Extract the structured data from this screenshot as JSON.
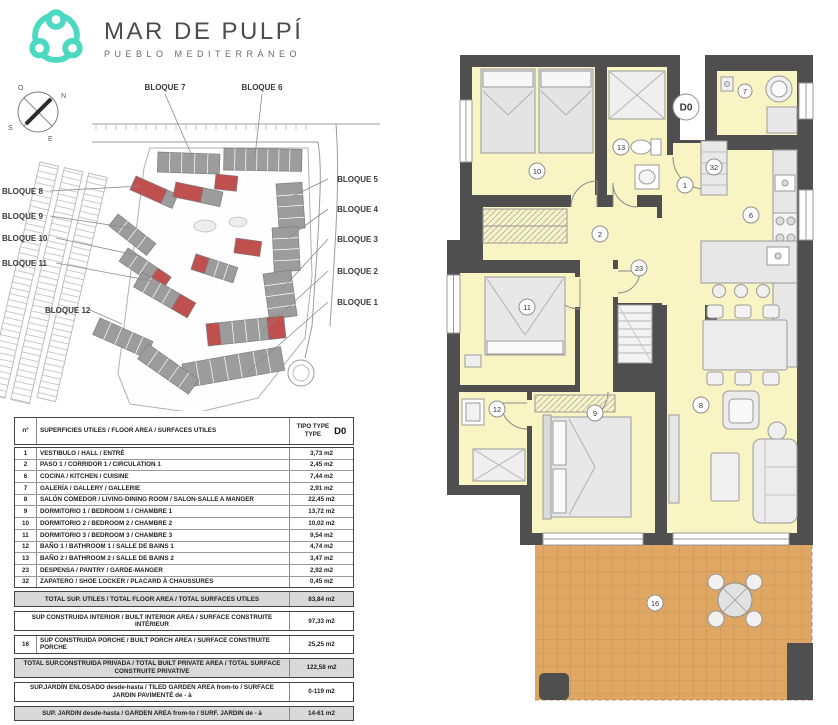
{
  "brand": {
    "title": "MAR DE PULPÍ",
    "subtitle": "PUEBLO MEDITERRÁNEO",
    "accent": "#4BD9C2"
  },
  "siteplan": {
    "compass": {
      "n": "N",
      "s": "S",
      "e": "E",
      "o": "O"
    },
    "blocks": [
      {
        "label": "BLOQUE 7",
        "x": 165,
        "y": 14,
        "anchor": "middle",
        "line": [
          165,
          18,
          192,
          80
        ]
      },
      {
        "label": "BLOQUE 6",
        "x": 262,
        "y": 14,
        "anchor": "middle",
        "line": [
          262,
          18,
          255,
          80
        ]
      },
      {
        "label": "BLOQUE 5",
        "x": 378,
        "y": 106,
        "anchor": "end",
        "line": [
          328,
          103,
          293,
          120
        ]
      },
      {
        "label": "BLOQUE 4",
        "x": 378,
        "y": 136,
        "anchor": "end",
        "line": [
          328,
          133,
          288,
          162
        ]
      },
      {
        "label": "BLOQUE 3",
        "x": 378,
        "y": 166,
        "anchor": "end",
        "line": [
          328,
          163,
          283,
          212
        ]
      },
      {
        "label": "BLOQUE 2",
        "x": 378,
        "y": 198,
        "anchor": "end",
        "line": [
          328,
          195,
          262,
          255
        ]
      },
      {
        "label": "BLOQUE 1",
        "x": 378,
        "y": 229,
        "anchor": "end",
        "line": [
          328,
          226,
          248,
          296
        ]
      },
      {
        "label": "BLOQUE 8",
        "x": 2,
        "y": 118,
        "anchor": "start",
        "line": [
          50,
          115,
          140,
          110
        ]
      },
      {
        "label": "BLOQUE 9",
        "x": 2,
        "y": 143,
        "anchor": "start",
        "line": [
          50,
          140,
          130,
          152
        ]
      },
      {
        "label": "BLOQUE 10",
        "x": 2,
        "y": 165,
        "anchor": "start",
        "line": [
          56,
          162,
          140,
          180
        ]
      },
      {
        "label": "BLOQUE 11",
        "x": 2,
        "y": 190,
        "anchor": "start",
        "line": [
          56,
          187,
          152,
          205
        ]
      },
      {
        "label": "BLOQUE 12",
        "x": 45,
        "y": 237,
        "anchor": "start",
        "line": [
          90,
          234,
          122,
          248
        ]
      }
    ]
  },
  "floorplan": {
    "unit_code": "D0",
    "colors": {
      "room": "#f8f4c3",
      "wall": "#4f4f4f",
      "terrace": "#dfa763"
    },
    "room_labels": [
      {
        "n": "D0",
        "x": 251,
        "y": 52,
        "r": 13,
        "big": true
      },
      {
        "n": "10",
        "x": 102,
        "y": 116,
        "r": 8
      },
      {
        "n": "13",
        "x": 186,
        "y": 92,
        "r": 8
      },
      {
        "n": "7",
        "x": 310,
        "y": 36,
        "r": 7
      },
      {
        "n": "32",
        "x": 279,
        "y": 112,
        "r": 8
      },
      {
        "n": "1",
        "x": 250,
        "y": 130,
        "r": 8
      },
      {
        "n": "2",
        "x": 165,
        "y": 179,
        "r": 8
      },
      {
        "n": "6",
        "x": 316,
        "y": 160,
        "r": 8
      },
      {
        "n": "11",
        "x": 92,
        "y": 252,
        "r": 8
      },
      {
        "n": "23",
        "x": 204,
        "y": 213,
        "r": 8
      },
      {
        "n": "12",
        "x": 62,
        "y": 354,
        "r": 8
      },
      {
        "n": "9",
        "x": 160,
        "y": 358,
        "r": 8
      },
      {
        "n": "8",
        "x": 266,
        "y": 350,
        "r": 8
      },
      {
        "n": "16",
        "x": 220,
        "y": 548,
        "r": 8
      }
    ]
  },
  "table": {
    "header": {
      "col_no": "nº",
      "col_desc": "SUPERFICIES UTILES / FLOOR AREA / SURFACES UTILES",
      "type_line1": "TIPO TYPE",
      "type_line2": "TYPE",
      "type_code": "D0"
    },
    "rows": [
      {
        "no": "1",
        "desc": "VESTIBULO / HALL / ENTRÉ",
        "value": "3,73 m2"
      },
      {
        "no": "2",
        "desc": "PASO 1 / CORRIDOR 1 / CIRCULATION 1",
        "value": "2,45 m2"
      },
      {
        "no": "6",
        "desc": "COCINA / KITCHEN / CUISINE",
        "value": "7,44 m2"
      },
      {
        "no": "7",
        "desc": "GALERÍA / GALLERY / GALLERIE",
        "value": "2,91 m2"
      },
      {
        "no": "8",
        "desc": "SALÓN COMEDOR  / LIVING-DINING ROOM / SALON-SALLE A MANGER",
        "value": "22,45 m2"
      },
      {
        "no": "9",
        "desc": "DORMITORIO 1 / BEDROOM 1 / CHAMBRE 1",
        "value": "13,72 m2"
      },
      {
        "no": "10",
        "desc": "DORMITORIO 2 / BEDROOM 2 / CHAMBRE 2",
        "value": "10,02 m2"
      },
      {
        "no": "11",
        "desc": "DORMITORIO 3 / BEDROOM 3 / CHAMBRE 3",
        "value": "9,54 m2"
      },
      {
        "no": "12",
        "desc": "BAÑO 1 / BATHROOM 1 / SALLE DE BAINS 1",
        "value": "4,74 m2"
      },
      {
        "no": "13",
        "desc": "BAÑO 2 / BATHROOM 2 / SALLE DE BAINS 2",
        "value": "3,47 m2"
      },
      {
        "no": "23",
        "desc": "DESPENSA / PANTRY / GARDE-MANGER",
        "value": "2,92 m2"
      },
      {
        "no": "32",
        "desc": "ZAPATERO / SHOE LOCKER / PLACARD À CHAUSSURES",
        "value": "0,45 m2"
      }
    ],
    "summary": [
      {
        "no": "",
        "desc": "TOTAL SUP. UTILES / TOTAL FLOOR AREA / TOTAL SURFACES UTILES",
        "value": "83,84 m2",
        "shade": true,
        "h": 14
      },
      {
        "no": "",
        "desc": "SUP CONSTRUIDA INTERIOR / BUILT INTERIOR AREA /  SURFACE CONSTRUITE INTÉRIEUR",
        "value": "97,33 m2",
        "shade": false,
        "h": 18
      },
      {
        "no": "16",
        "desc": "SUP CONSTRUIDA PORCHE  / BUILT PORCH  AREA / SURFACE CONSTRUITE PORCHE",
        "value": "25,25 m2",
        "shade": false,
        "h": 14
      },
      {
        "no": "",
        "desc": "TOTAL SUP.CONSTRUIDA PRIVADA / TOTAL  BUILT PRIVATE AREA / TOTAL SURFACE CONSTRUITE PRIVATIVE",
        "value": "122,58 m2",
        "shade": true,
        "h": 18
      },
      {
        "no": "",
        "desc": "SUP.JARDÍN ENLOSADO desde-hasta / TILED GARDEN AREA from-to / SURFACE JARDIN PAVIMENTÉ  de - à",
        "value": "0-119 m2",
        "shade": false,
        "h": 18
      },
      {
        "no": "",
        "desc": "SUP. JARDIN desde-hasta / GARDEN AREA from-to / SURF. JARDIN  de - à",
        "value": "14-61 m2",
        "shade": true,
        "h": 13
      }
    ]
  }
}
